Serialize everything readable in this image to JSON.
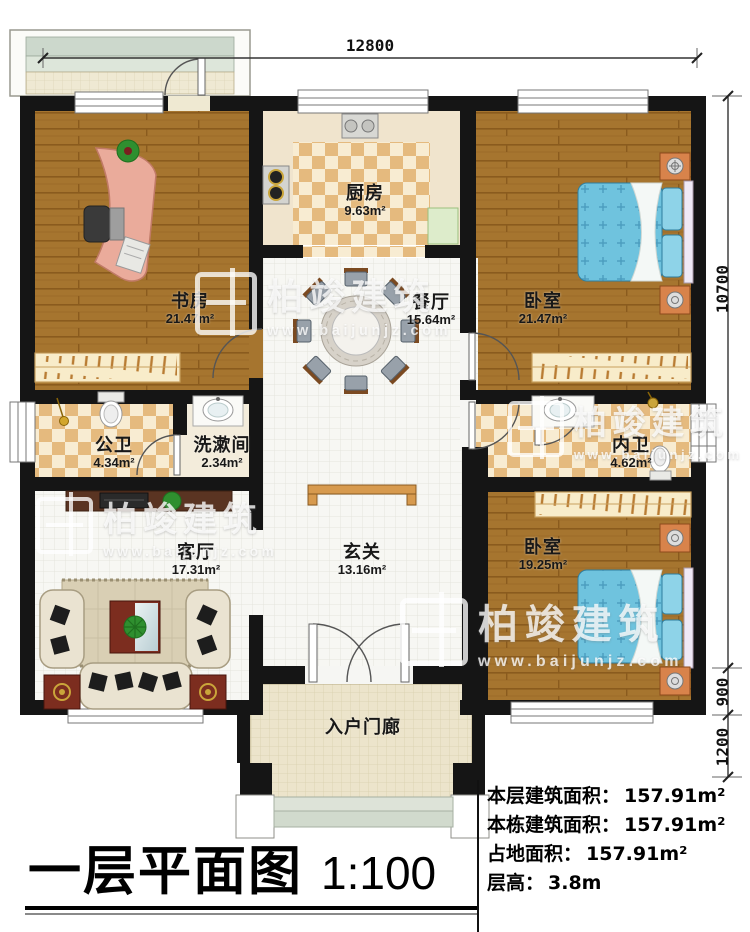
{
  "title": {
    "main": "一层平面图",
    "scale": "1:100"
  },
  "dims": {
    "top": "12800",
    "right": [
      "10700",
      "900",
      "1200"
    ]
  },
  "rooms": [
    {
      "id": "study",
      "name": "书房",
      "area": "21.47m²"
    },
    {
      "id": "kitchen",
      "name": "厨房",
      "area": "9.63m²"
    },
    {
      "id": "dining",
      "name": "餐厅",
      "area": "15.64m²"
    },
    {
      "id": "bedroom1",
      "name": "卧室",
      "area": "21.47m²"
    },
    {
      "id": "pubbath",
      "name": "公卫",
      "area": "4.34m²"
    },
    {
      "id": "washroom",
      "name": "洗漱间",
      "area": "2.34m²"
    },
    {
      "id": "innbath",
      "name": "内卫",
      "area": "4.62m²"
    },
    {
      "id": "living",
      "name": "客厅",
      "area": "17.31m²"
    },
    {
      "id": "foyer",
      "name": "玄关",
      "area": "13.16m²"
    },
    {
      "id": "bedroom2",
      "name": "卧室",
      "area": "19.25m²"
    },
    {
      "id": "porch",
      "name": "入户门廊",
      "area": ""
    }
  ],
  "info": [
    {
      "label": "本层建筑面积：",
      "value": "157.91m²"
    },
    {
      "label": "本栋建筑面积：",
      "value": "157.91m²"
    },
    {
      "label": "占地面积：",
      "value": "157.91m²"
    },
    {
      "label": "层高：",
      "value": "3.8m"
    }
  ],
  "watermark": {
    "brand": "柏竣建筑",
    "url": "www.baijunjz.com"
  },
  "colors": {
    "wall": "#151515",
    "wood": "#a6752f",
    "checker": "#e5ba7e",
    "bed": "#6fc3de",
    "accent_furniture": "#d8834b"
  }
}
